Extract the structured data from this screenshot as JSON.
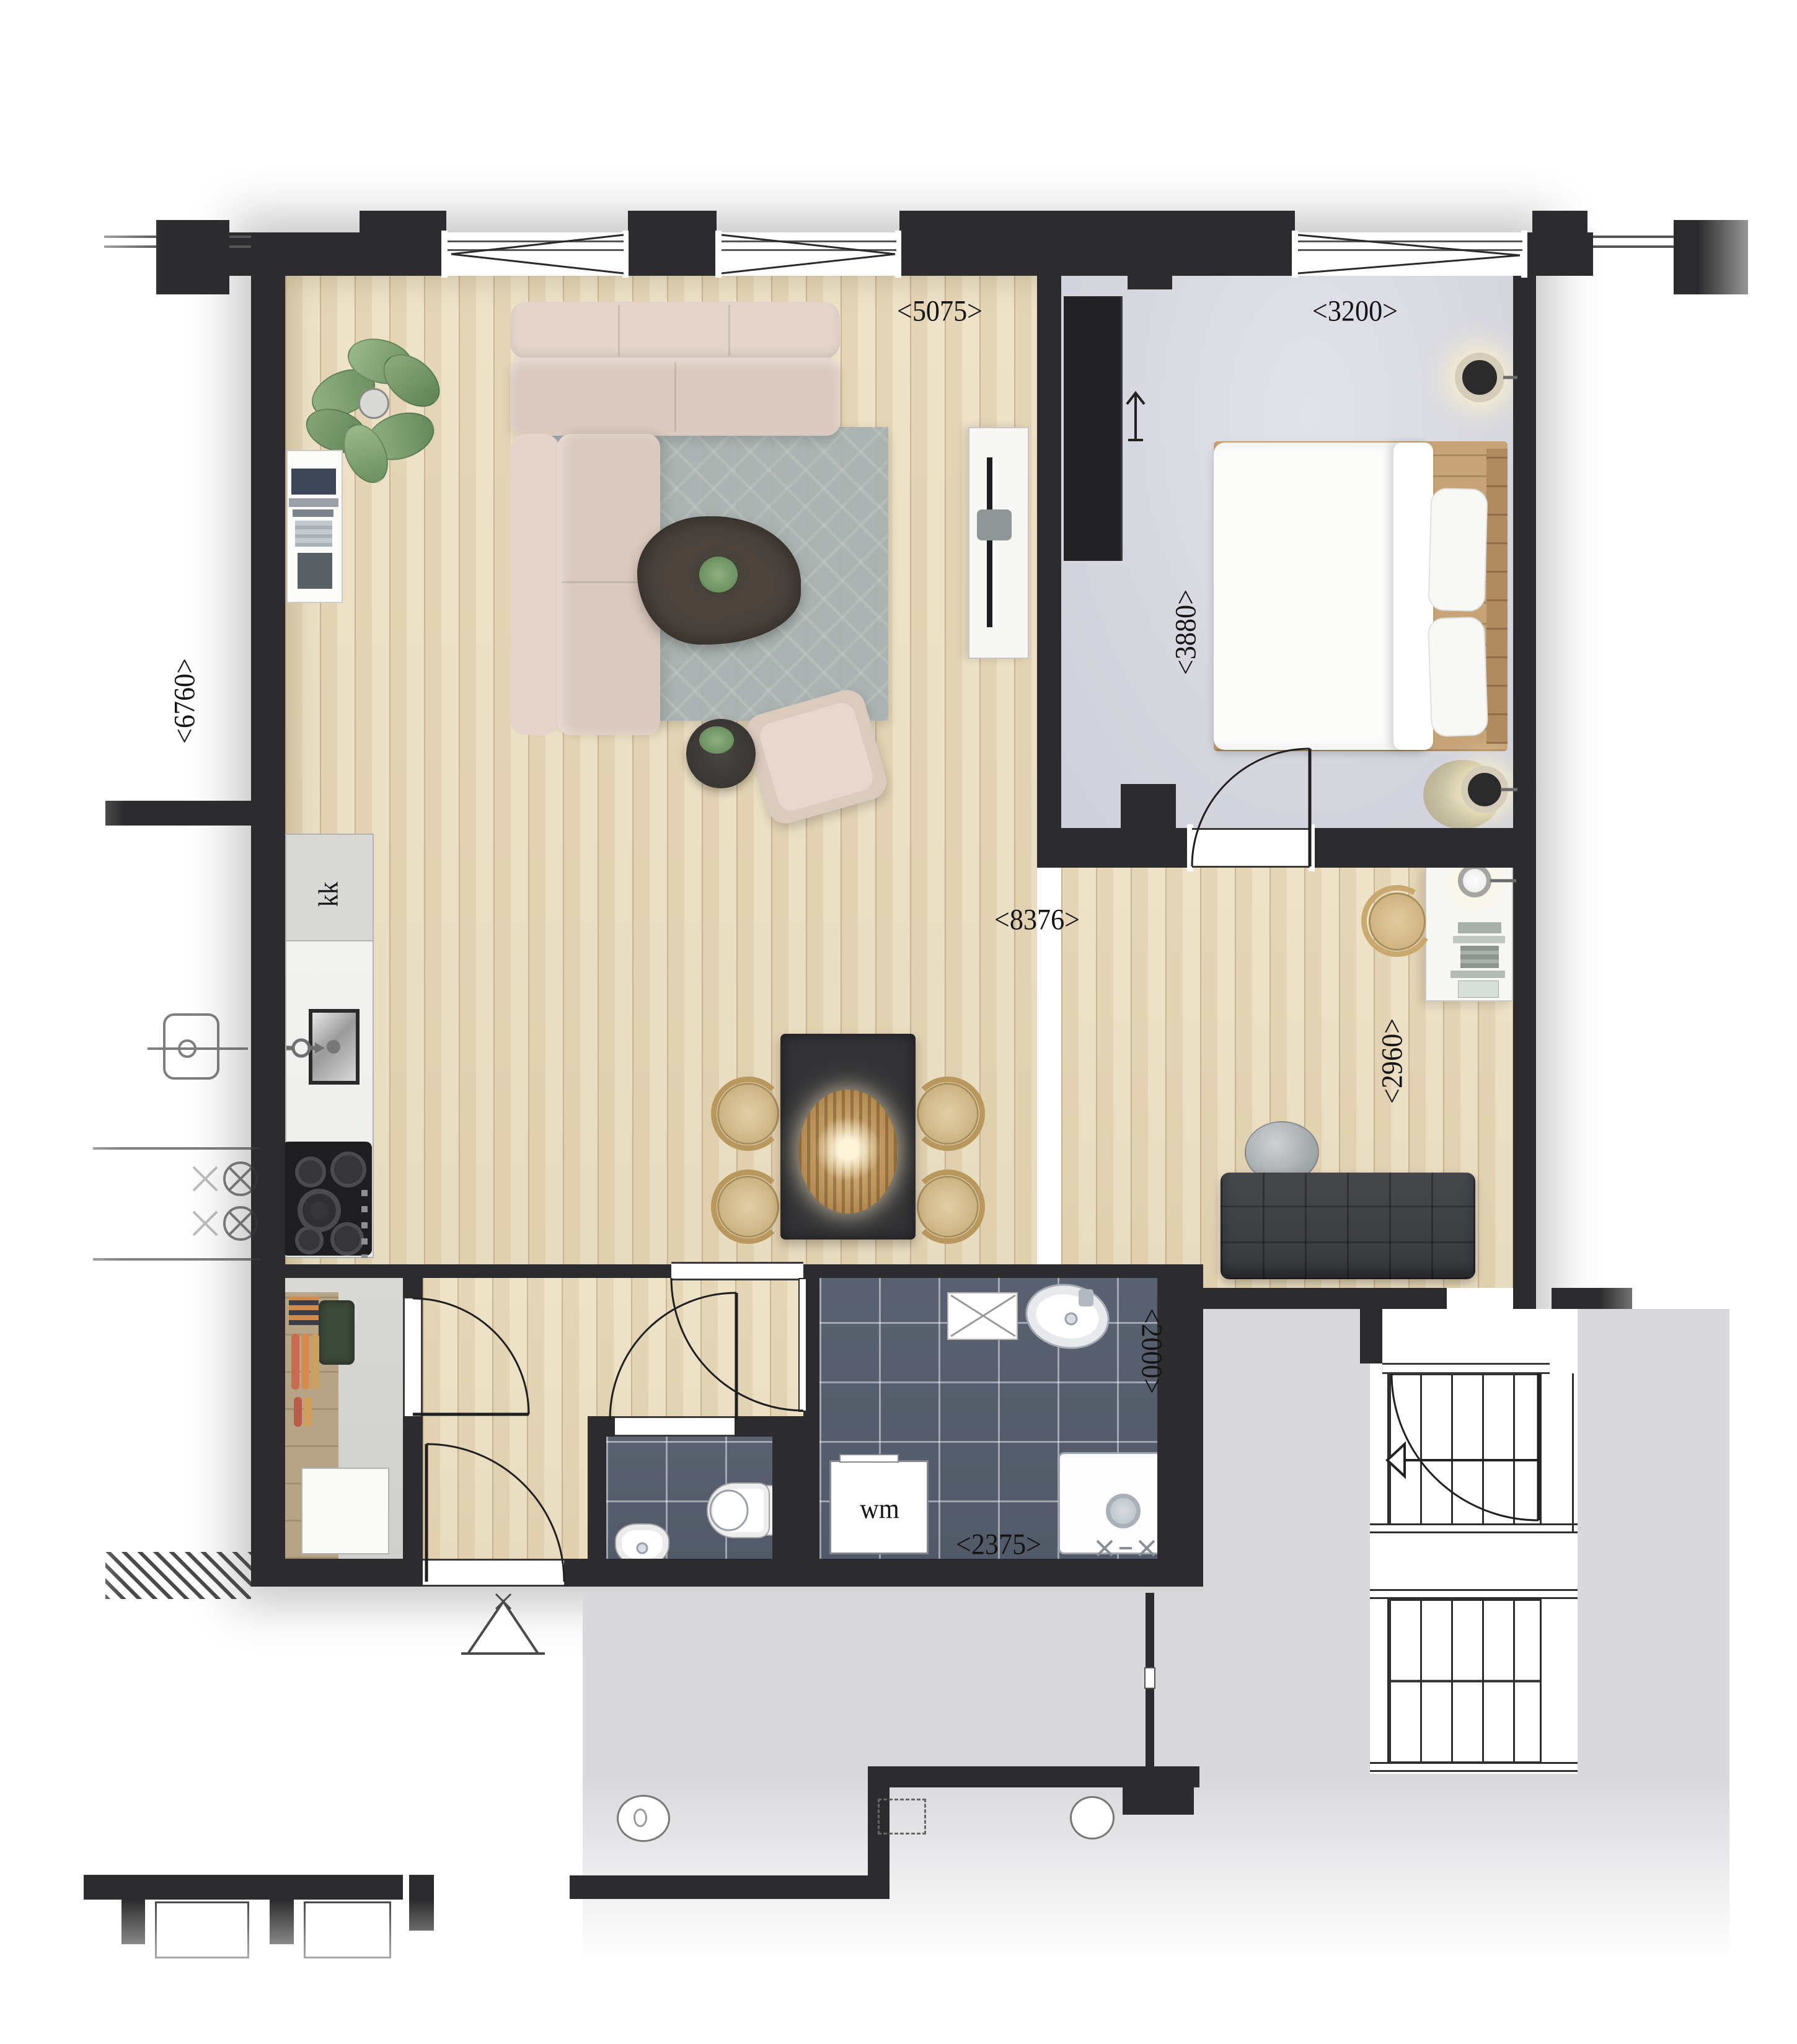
{
  "plan": {
    "dimensions": {
      "living_width": "<5075>",
      "bedroom_width": "<3200>",
      "living_depth": "<6760>",
      "bedroom_depth": "<3880>",
      "overall_width": "<8376>",
      "nook_depth": "<2960>",
      "bathroom_depth": "<2000>",
      "bathroom_width": "<2375>"
    },
    "labels": {
      "fridge": "kk",
      "washing_machine": "wm"
    },
    "colors": {
      "wall": "#2c2c2e",
      "wood_floor": "#eadfc5",
      "bedroom_floor": "#d9d9e1",
      "tile_floor": "#596070",
      "backdrop_gray": "#dadade",
      "bed_frame_wood": "#c7a478"
    }
  }
}
